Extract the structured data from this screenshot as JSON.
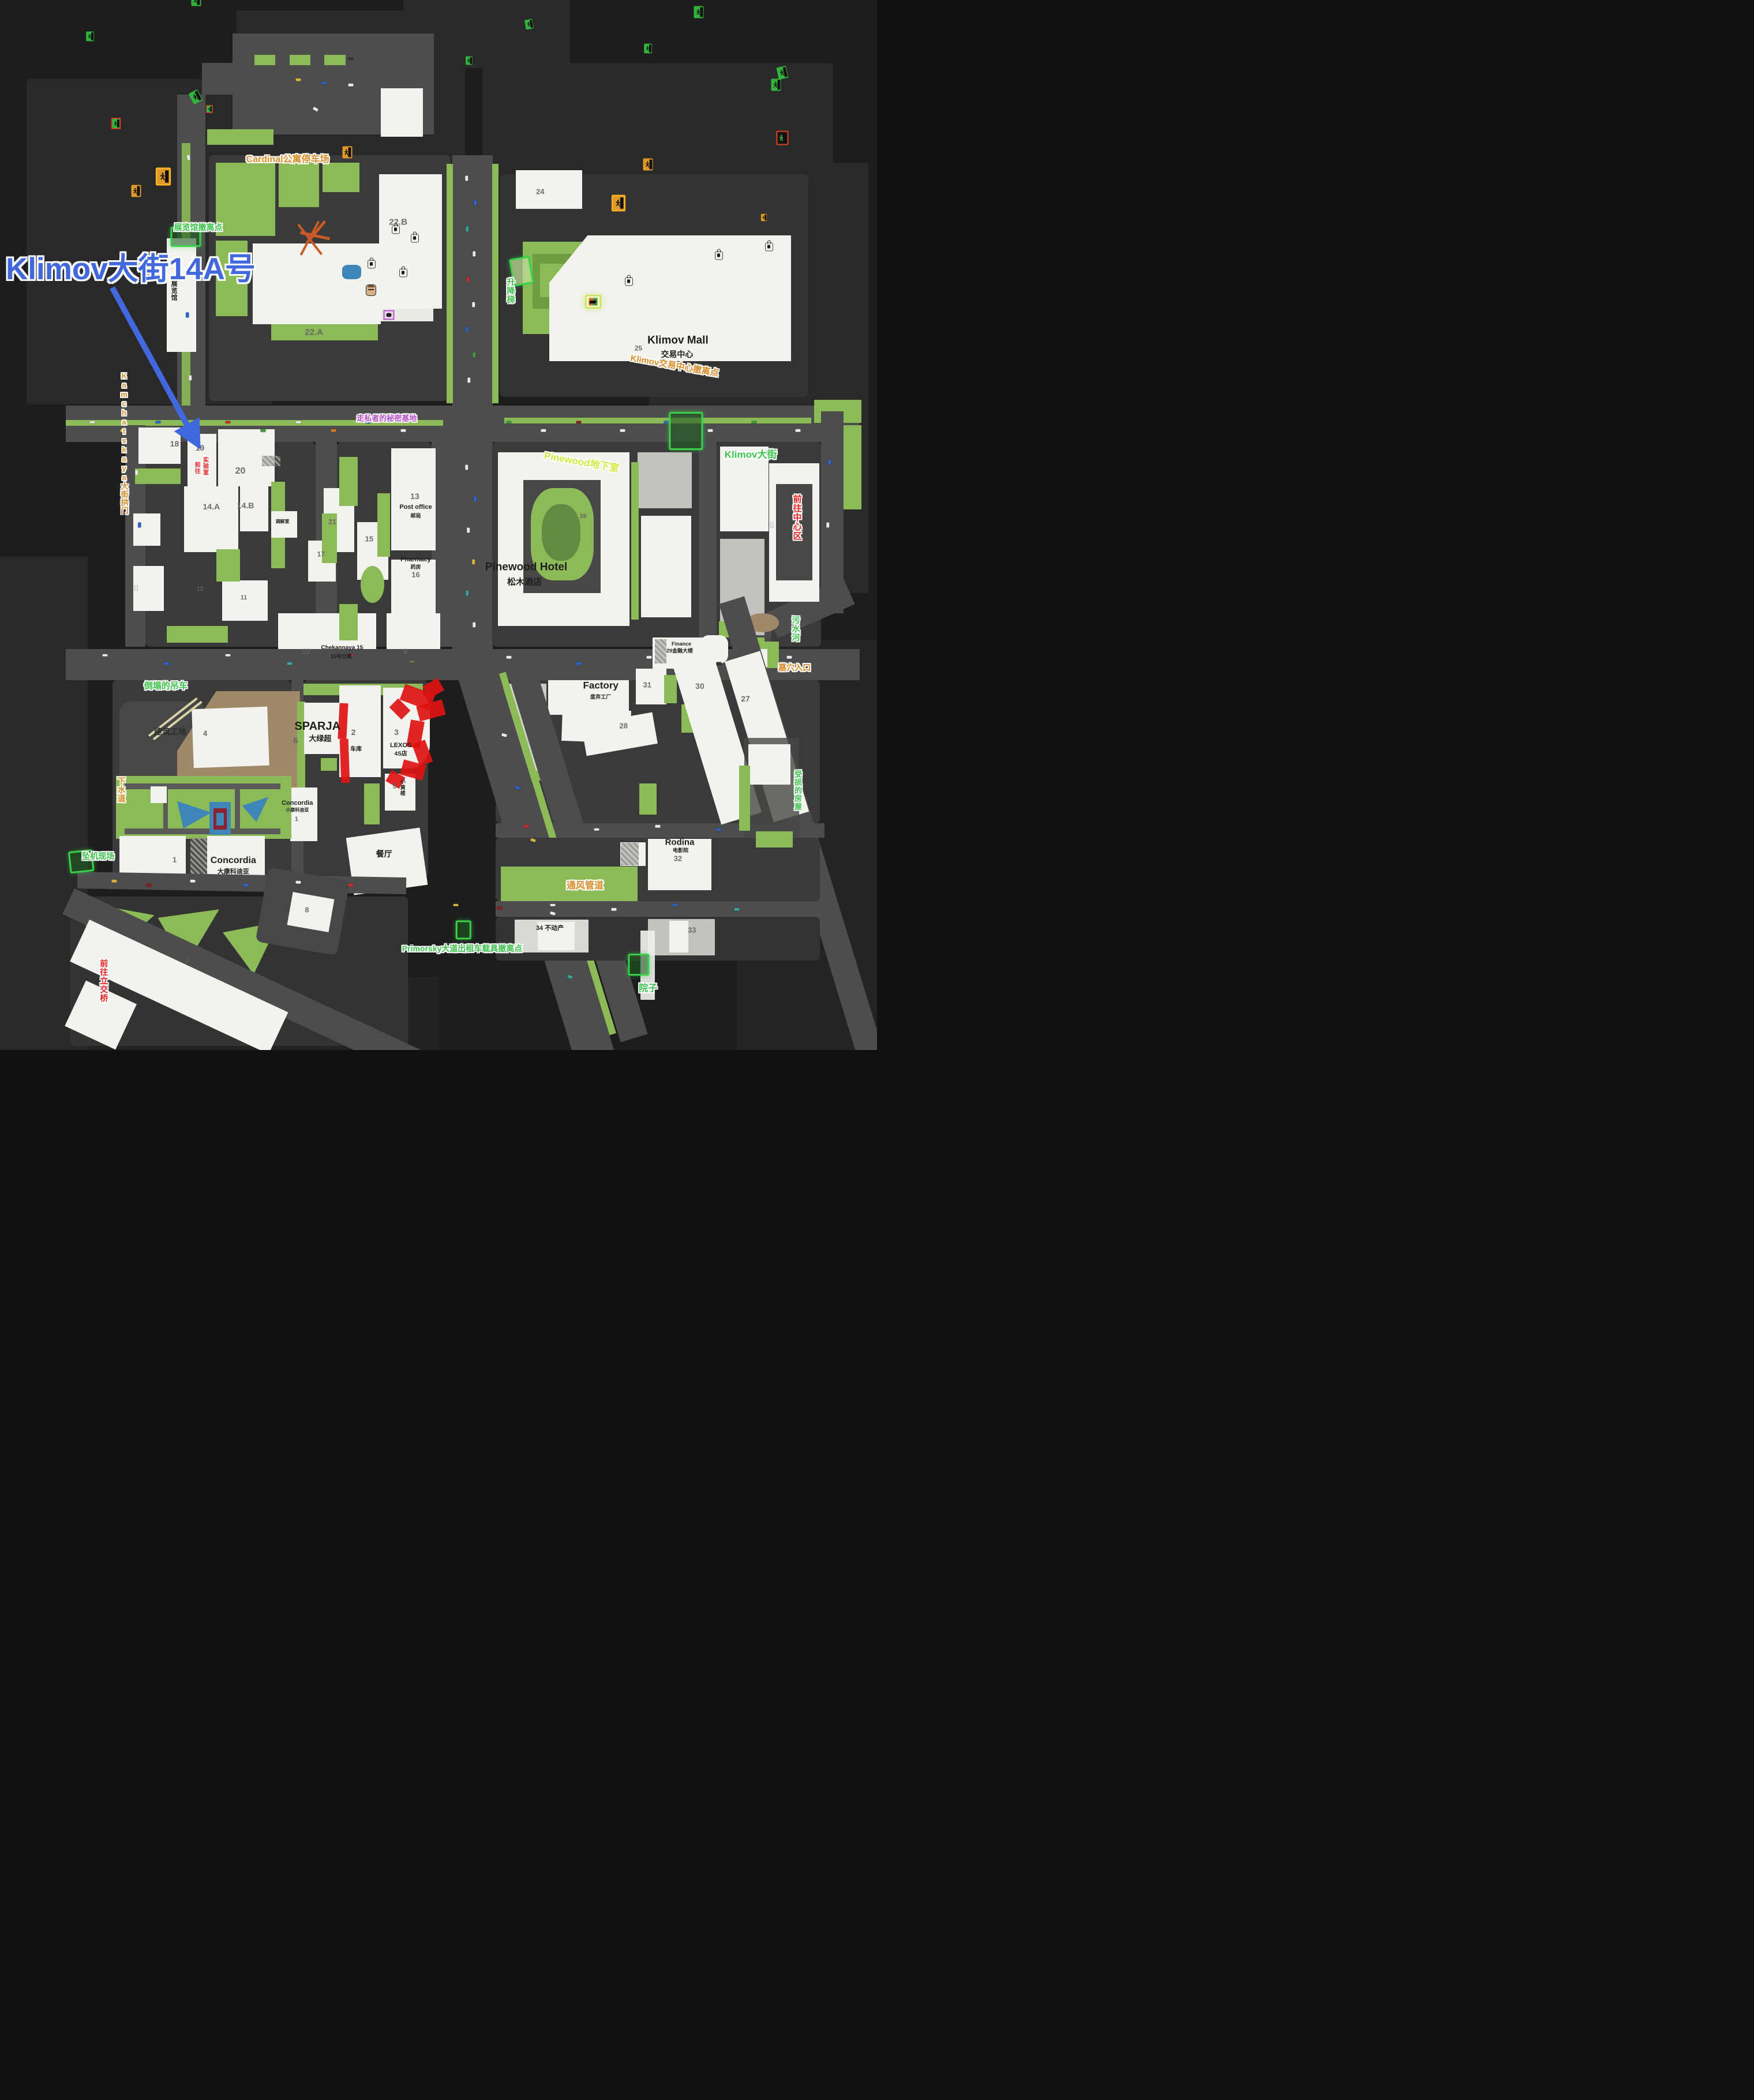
{
  "annotation": {
    "title": "Klimov大街14A号",
    "color": "#4168dd",
    "arrow": {
      "x1": 12.8,
      "y1": 27.4,
      "x2": 22.4,
      "y2": 42.1
    }
  },
  "styles": {
    "green": "#3ec24e",
    "orange": "#d98e2b",
    "red": "#e8201f",
    "purple": "#b653c8",
    "lime": "#cfe93f",
    "black": "#1e1e1e",
    "num": "#636363",
    "dark": "#2d2d2d"
  },
  "labels": [
    [
      "Cardinal公寓停车场",
      32.8,
      15.2,
      "orange",
      16,
      0,
      0
    ],
    [
      "展览馆撤离点",
      22.6,
      21.7,
      "green",
      14,
      0,
      0
    ],
    [
      "展览馆",
      19.8,
      27.7,
      "black",
      11,
      1,
      0
    ],
    [
      "22.B",
      45.4,
      21.2,
      "num",
      15,
      0,
      0
    ],
    [
      "24",
      61.6,
      18.3,
      "num",
      13,
      0,
      0
    ],
    [
      "22.A",
      35.8,
      31.7,
      "num",
      15,
      0,
      0
    ],
    [
      "升降梯",
      58.2,
      27.7,
      "green",
      14,
      1,
      0
    ],
    [
      "25",
      72.8,
      33.2,
      "num",
      12,
      0,
      0
    ],
    [
      "Klimov Mall",
      77.3,
      32.4,
      "black",
      19,
      0,
      0
    ],
    [
      "交易中心",
      77.2,
      33.8,
      "black",
      14,
      0,
      0
    ],
    [
      "Klimov交易中心撤离点",
      76.9,
      34.9,
      "orange",
      15,
      0,
      10
    ],
    [
      "Kamchatskaya大街拱门",
      14.1,
      42.2,
      "orange",
      13,
      1,
      0
    ],
    [
      "18",
      19.9,
      42.3,
      "num",
      14,
      0,
      0
    ],
    [
      "19",
      22.8,
      42.7,
      "num",
      14,
      0,
      0
    ],
    [
      "20",
      27.4,
      44.9,
      "num",
      16,
      0,
      0
    ],
    [
      "前往",
      22.4,
      44.55,
      "red",
      10,
      1,
      0
    ],
    [
      "实验室",
      23.35,
      44.4,
      "red",
      10,
      1,
      0
    ],
    [
      "走私者的秘密基地",
      44.1,
      39.9,
      "purple",
      13,
      0,
      0
    ],
    [
      "Pinewood地下室",
      66.3,
      44.0,
      "lime",
      17,
      0,
      10
    ],
    [
      "Klimov大街",
      85.6,
      43.3,
      "green",
      17,
      0,
      0
    ],
    [
      "前往中心区",
      90.8,
      49.3,
      "red",
      15,
      1,
      0
    ],
    [
      "14.A",
      24.1,
      48.3,
      "num",
      14,
      0,
      0
    ],
    [
      "14.B",
      28.0,
      48.2,
      "num",
      14,
      0,
      0
    ],
    [
      "调解室",
      32.2,
      49.7,
      "black",
      8,
      0,
      0
    ],
    [
      "13",
      47.3,
      47.3,
      "num",
      14,
      0,
      0
    ],
    [
      "Post office",
      47.4,
      48.3,
      "black",
      11,
      0,
      0
    ],
    [
      "邮局",
      47.4,
      49.1,
      "black",
      9,
      0,
      0
    ],
    [
      "15",
      42.1,
      51.4,
      "num",
      13,
      0,
      0
    ],
    [
      "21",
      37.9,
      49.7,
      "num",
      12,
      0,
      0
    ],
    [
      "17",
      36.6,
      52.8,
      "num",
      12,
      0,
      0
    ],
    [
      "Pharmacy",
      47.4,
      53.3,
      "black",
      11,
      0,
      0
    ],
    [
      "药房",
      47.4,
      54.0,
      "black",
      9,
      0,
      0
    ],
    [
      "16",
      47.4,
      54.8,
      "num",
      13,
      0,
      0
    ],
    [
      "12",
      22.8,
      56.1,
      "num",
      11,
      0,
      0
    ],
    [
      "11",
      27.8,
      56.9,
      "num",
      11,
      0,
      0
    ],
    [
      "Pinewood Hotel",
      60.0,
      54.0,
      "black",
      19,
      0,
      0
    ],
    [
      "松木酒店",
      59.8,
      55.5,
      "black",
      15,
      0,
      0
    ],
    [
      "26",
      66.5,
      49.2,
      "num",
      11,
      0,
      0
    ],
    [
      "10",
      34.9,
      62.1,
      "num",
      13,
      0,
      0
    ],
    [
      "Chekannaya 15",
      39.0,
      61.7,
      "black",
      10,
      0,
      0
    ],
    [
      "15号公寓",
      38.9,
      62.5,
      "black",
      9,
      0,
      0
    ],
    [
      "9",
      46.2,
      62.1,
      "num",
      13,
      0,
      0
    ],
    [
      "污水河",
      90.7,
      59.9,
      "green",
      14,
      1,
      0
    ],
    [
      "墓穴入口",
      90.6,
      63.6,
      "orange",
      14,
      0,
      0
    ],
    [
      "Factory",
      68.5,
      65.3,
      "black",
      17,
      0,
      0
    ],
    [
      "废弃工厂",
      68.5,
      66.4,
      "black",
      9,
      0,
      0
    ],
    [
      "Finance",
      77.7,
      61.3,
      "black",
      9,
      0,
      0
    ],
    [
      "29金融大楼",
      77.5,
      62.0,
      "black",
      9,
      0,
      0
    ],
    [
      "31",
      73.8,
      65.3,
      "num",
      13,
      0,
      0
    ],
    [
      "30",
      79.8,
      65.4,
      "num",
      14,
      0,
      0
    ],
    [
      "28",
      71.1,
      69.2,
      "num",
      13,
      0,
      0
    ],
    [
      "27",
      85.0,
      66.6,
      "num",
      14,
      0,
      0
    ],
    [
      "受损的房屋",
      90.9,
      75.3,
      "green",
      13,
      1,
      0
    ],
    [
      "倒塌的吊车",
      18.9,
      65.4,
      "green",
      15,
      0,
      0
    ],
    [
      "建筑工地",
      19.4,
      69.7,
      "dark",
      14,
      0,
      0
    ],
    [
      "4",
      23.4,
      69.9,
      "num",
      13,
      0,
      0
    ],
    [
      "SPARJA",
      36.2,
      69.2,
      "black",
      20,
      0,
      0
    ],
    [
      "大绿超",
      36.5,
      70.4,
      "black",
      13,
      0,
      0
    ],
    [
      "6",
      33.7,
      70.6,
      "num",
      15,
      0,
      0
    ],
    [
      "2",
      40.3,
      69.8,
      "num",
      14,
      0,
      0
    ],
    [
      "车库",
      40.6,
      71.4,
      "black",
      10,
      0,
      0
    ],
    [
      "3",
      45.2,
      69.8,
      "num",
      14,
      0,
      0
    ],
    [
      "LEXOS",
      45.7,
      71.0,
      "black",
      11,
      0,
      0
    ],
    [
      "4S店",
      45.7,
      71.8,
      "black",
      10,
      0,
      0
    ],
    [
      "5",
      45.0,
      74.9,
      "num",
      12,
      0,
      0
    ],
    [
      "小黄楼",
      45.9,
      75.0,
      "black",
      9,
      1,
      0
    ],
    [
      "下水道",
      13.8,
      75.2,
      "orange",
      14,
      1,
      0
    ],
    [
      "Concordia",
      33.9,
      76.5,
      "black",
      11,
      0,
      0
    ],
    [
      "小康科迪亚",
      33.9,
      77.2,
      "black",
      8,
      0,
      0
    ],
    [
      "1",
      33.8,
      78.0,
      "num",
      11,
      0,
      0
    ],
    [
      "Concordia",
      26.6,
      82.0,
      "black",
      16,
      0,
      0
    ],
    [
      "大康科迪亚",
      26.6,
      83.0,
      "black",
      11,
      0,
      0
    ],
    [
      "1",
      19.9,
      81.9,
      "num",
      13,
      0,
      0
    ],
    [
      "坠机现场",
      11.2,
      81.6,
      "green",
      14,
      0,
      0
    ],
    [
      "餐厅",
      43.8,
      81.4,
      "black",
      14,
      0,
      0
    ],
    [
      "Rodina",
      77.5,
      80.3,
      "black",
      15,
      0,
      0
    ],
    [
      "电影院",
      77.6,
      81.0,
      "black",
      9,
      0,
      0
    ],
    [
      "32",
      77.3,
      81.8,
      "num",
      13,
      0,
      0
    ],
    [
      "通风管道",
      66.7,
      84.4,
      "orange",
      16,
      0,
      0
    ],
    [
      "34 不动产",
      62.7,
      88.4,
      "black",
      11,
      0,
      0
    ],
    [
      "33",
      78.9,
      88.6,
      "num",
      13,
      0,
      0
    ],
    [
      "Primorsky大道出租车载具撤离点",
      52.7,
      90.4,
      "green",
      14,
      0,
      0
    ],
    [
      "院子",
      73.9,
      94.2,
      "green",
      16,
      0,
      0
    ],
    [
      "前往立交桥",
      11.8,
      93.4,
      "red",
      14,
      1,
      0
    ],
    [
      "7",
      21.3,
      91.6,
      "num",
      12,
      0,
      30
    ],
    [
      "8",
      35.0,
      86.7,
      "num",
      13,
      0,
      0
    ]
  ],
  "icons": [
    {
      "k": "zone",
      "x": 21.2,
      "y": 22.55,
      "w": 3.1,
      "h": 1.55
    },
    {
      "k": "zone",
      "x": 78.2,
      "y": 41.05,
      "w": 3.5,
      "h": 3.3
    },
    {
      "k": "zone",
      "x": 59.45,
      "y": 25.8,
      "w": 2.0,
      "h": 2.3,
      "r": -10,
      "v": "light"
    },
    {
      "k": "zone",
      "x": 9.3,
      "y": 82.05,
      "w": 2.4,
      "h": 1.75,
      "r": -6
    },
    {
      "k": "zone",
      "x": 72.85,
      "y": 91.85,
      "w": 2.05,
      "h": 1.75
    },
    {
      "k": "zone",
      "x": 52.85,
      "y": 88.55,
      "w": 1.35,
      "h": 1.5
    },
    {
      "k": "exg",
      "x": 22.35,
      "y": 23.3
    },
    {
      "k": "exg",
      "x": 79.7,
      "y": 42.3
    },
    {
      "k": "exg",
      "x": 60.35,
      "y": 26.9,
      "r": -10,
      "s": 0.8
    },
    {
      "k": "exg",
      "x": 10.25,
      "y": 82.85,
      "s": 0.8
    },
    {
      "k": "exg",
      "x": 73.85,
      "y": 92.7,
      "s": 0.8
    },
    {
      "k": "exg",
      "x": 53.5,
      "y": 89.25,
      "s": 0.7
    },
    {
      "k": "exg",
      "x": 89.2,
      "y": 59.75,
      "r": -12
    },
    {
      "k": "exg",
      "x": 88.5,
      "y": 75.4
    },
    {
      "k": "exg",
      "x": 22.3,
      "y": 66.4,
      "r": -28
    },
    {
      "k": "exg",
      "x": 23.9,
      "y": 45.0,
      "s": 0.55,
      "v": "rb"
    },
    {
      "k": "exg",
      "x": 13.2,
      "y": 92.4,
      "s": 0.8,
      "v": "rb"
    },
    {
      "k": "exr",
      "x": 89.2,
      "y": 49.4
    },
    {
      "k": "exo",
      "x": 39.6,
      "y": 17.2
    },
    {
      "k": "exo",
      "x": 73.9,
      "y": 36.1
    },
    {
      "k": "exo",
      "x": 18.65,
      "y": 42.0,
      "s": 1.25,
      "v": "ob"
    },
    {
      "k": "exo",
      "x": 15.5,
      "y": 75.2
    },
    {
      "k": "exo",
      "x": 70.5,
      "y": 85.9,
      "s": 1.15,
      "v": "ob"
    },
    {
      "k": "exo",
      "x": 87.1,
      "y": 63.1,
      "s": 0.6
    },
    {
      "k": "lock",
      "x": 45.1,
      "y": 26.6
    },
    {
      "k": "lock",
      "x": 47.3,
      "y": 29.3
    },
    {
      "k": "lock",
      "x": 87.7,
      "y": 53.7
    },
    {
      "k": "lock",
      "x": 82.0,
      "y": 69.5
    },
    {
      "k": "lock",
      "x": 42.4,
      "y": 70.3
    },
    {
      "k": "lock",
      "x": 46.0,
      "y": 73.9
    },
    {
      "k": "lock",
      "x": 71.7,
      "y": 80.6
    },
    {
      "k": "boss",
      "x": 42.3,
      "y": 69.4
    },
    {
      "k": "trader",
      "x": 67.6,
      "y": 42.4
    },
    {
      "k": "smug",
      "x": 44.35,
      "y": 40.85
    }
  ],
  "vehicle_colors": {
    "w": "#e9e9e9",
    "b": "#2f63cc",
    "t": "#3aa0a0",
    "r": "#c03030",
    "g": "#3f9a3f",
    "y": "#d6b33d",
    "o": "#d07a2c",
    "dr": "#8a1f1f",
    "dk": "#33333b",
    "ol": "#6b7a4a"
  },
  "vehicles": [
    [
      53.2,
      17,
      90,
      "w"
    ],
    [
      54.2,
      19.3,
      90,
      "b"
    ],
    [
      53.3,
      21.8,
      92,
      "t"
    ],
    [
      54.1,
      24.2,
      90,
      "w"
    ],
    [
      53.4,
      26.6,
      88,
      "r"
    ],
    [
      54,
      29,
      90,
      "w"
    ],
    [
      53.3,
      31.4,
      90,
      "b"
    ],
    [
      54.1,
      33.8,
      90,
      "g"
    ],
    [
      53.5,
      36.2,
      90,
      "w"
    ],
    [
      53.2,
      44.5,
      90,
      "w"
    ],
    [
      54.2,
      47.5,
      90,
      "b"
    ],
    [
      53.4,
      50.5,
      88,
      "w"
    ],
    [
      54,
      53.5,
      90,
      "y"
    ],
    [
      53.3,
      56.5,
      90,
      "t"
    ],
    [
      54.1,
      59.5,
      90,
      "w"
    ],
    [
      10.5,
      40.2,
      0,
      "w"
    ],
    [
      14,
      41,
      0,
      "y"
    ],
    [
      18,
      40.2,
      0,
      "b"
    ],
    [
      22,
      41,
      5,
      "w"
    ],
    [
      26,
      40.2,
      0,
      "r"
    ],
    [
      30,
      41,
      0,
      "g"
    ],
    [
      34,
      40.2,
      0,
      "w"
    ],
    [
      38,
      41,
      0,
      "o"
    ],
    [
      42,
      40.2,
      0,
      "b"
    ],
    [
      46,
      41,
      0,
      "w"
    ],
    [
      58,
      40.2,
      0,
      "g"
    ],
    [
      62,
      41,
      0,
      "w"
    ],
    [
      66,
      40.2,
      0,
      "dr"
    ],
    [
      71,
      41,
      0,
      "w"
    ],
    [
      76,
      40.2,
      0,
      "b"
    ],
    [
      81,
      41,
      0,
      "w"
    ],
    [
      86,
      40.2,
      0,
      "g"
    ],
    [
      91,
      41,
      0,
      "w"
    ],
    [
      12,
      62.4,
      0,
      "w"
    ],
    [
      19,
      63.2,
      0,
      "b"
    ],
    [
      26,
      62.4,
      0,
      "w"
    ],
    [
      33,
      63.2,
      0,
      "t"
    ],
    [
      40,
      62.4,
      0,
      "r"
    ],
    [
      47,
      63,
      0,
      "ol"
    ],
    [
      58,
      62.6,
      0,
      "w"
    ],
    [
      66,
      63.2,
      0,
      "b"
    ],
    [
      74,
      62.6,
      0,
      "w"
    ],
    [
      82,
      63.2,
      0,
      "dk"
    ],
    [
      90,
      62.6,
      0,
      "w"
    ],
    [
      15.6,
      45,
      88,
      "w"
    ],
    [
      15.9,
      50,
      92,
      "b"
    ],
    [
      15.5,
      56,
      90,
      "w"
    ],
    [
      34,
      7.6,
      0,
      "y"
    ],
    [
      37,
      7.9,
      0,
      "b"
    ],
    [
      40,
      8.1,
      0,
      "w"
    ],
    [
      36,
      10.4,
      30,
      "w"
    ],
    [
      40,
      5.6,
      0,
      "dk"
    ],
    [
      57.5,
      70,
      17,
      "w"
    ],
    [
      59,
      75,
      17,
      "b"
    ],
    [
      60.8,
      80,
      17,
      "y"
    ],
    [
      63,
      87,
      17,
      "w"
    ],
    [
      65,
      93,
      17,
      "t"
    ],
    [
      13,
      83.9,
      2,
      "y"
    ],
    [
      17,
      84.3,
      2,
      "dr"
    ],
    [
      22,
      83.9,
      2,
      "w"
    ],
    [
      28,
      84.3,
      2,
      "b"
    ],
    [
      34,
      84,
      2,
      "w"
    ],
    [
      40,
      84.3,
      2,
      "r"
    ],
    [
      52,
      86.2,
      0,
      "y"
    ],
    [
      57,
      86.5,
      0,
      "dr"
    ],
    [
      63,
      86.2,
      0,
      "w"
    ],
    [
      70,
      86.6,
      0,
      "w"
    ],
    [
      77,
      86.2,
      0,
      "b"
    ],
    [
      84,
      86.6,
      0,
      "t"
    ],
    [
      60,
      78.7,
      0,
      "r"
    ],
    [
      68,
      79,
      0,
      "w"
    ],
    [
      75,
      78.7,
      0,
      "w"
    ],
    [
      82,
      79,
      0,
      "b"
    ],
    [
      88,
      50,
      80,
      "w"
    ],
    [
      94.6,
      44,
      85,
      "b"
    ],
    [
      94.4,
      50,
      92,
      "w"
    ],
    [
      21.5,
      15,
      85,
      "w"
    ],
    [
      21.8,
      22,
      95,
      "g"
    ],
    [
      21.4,
      30,
      90,
      "b"
    ],
    [
      21.7,
      36,
      88,
      "w"
    ]
  ]
}
